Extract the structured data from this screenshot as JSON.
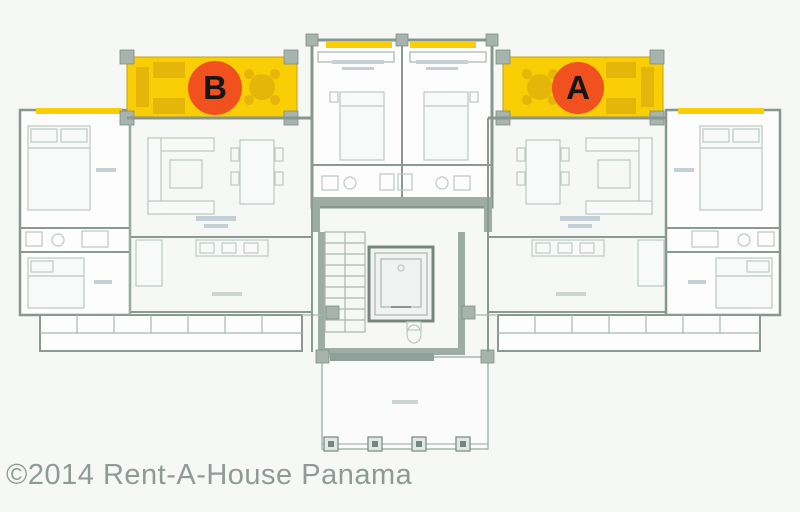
{
  "title": "Apartment building floor plan with units A and B",
  "units": [
    {
      "label": "B"
    },
    {
      "label": "A"
    }
  ],
  "colors": {
    "highlight": "#f9ce05",
    "highlight_accent": "#e5b50a",
    "badge": "#f1511f",
    "walls": "#87978f",
    "background": "#f6f8f6",
    "watermark": "#8f9a98"
  },
  "watermark": {
    "text": "©2014 Rent-A-House Panama",
    "color": "#8f9a98"
  }
}
